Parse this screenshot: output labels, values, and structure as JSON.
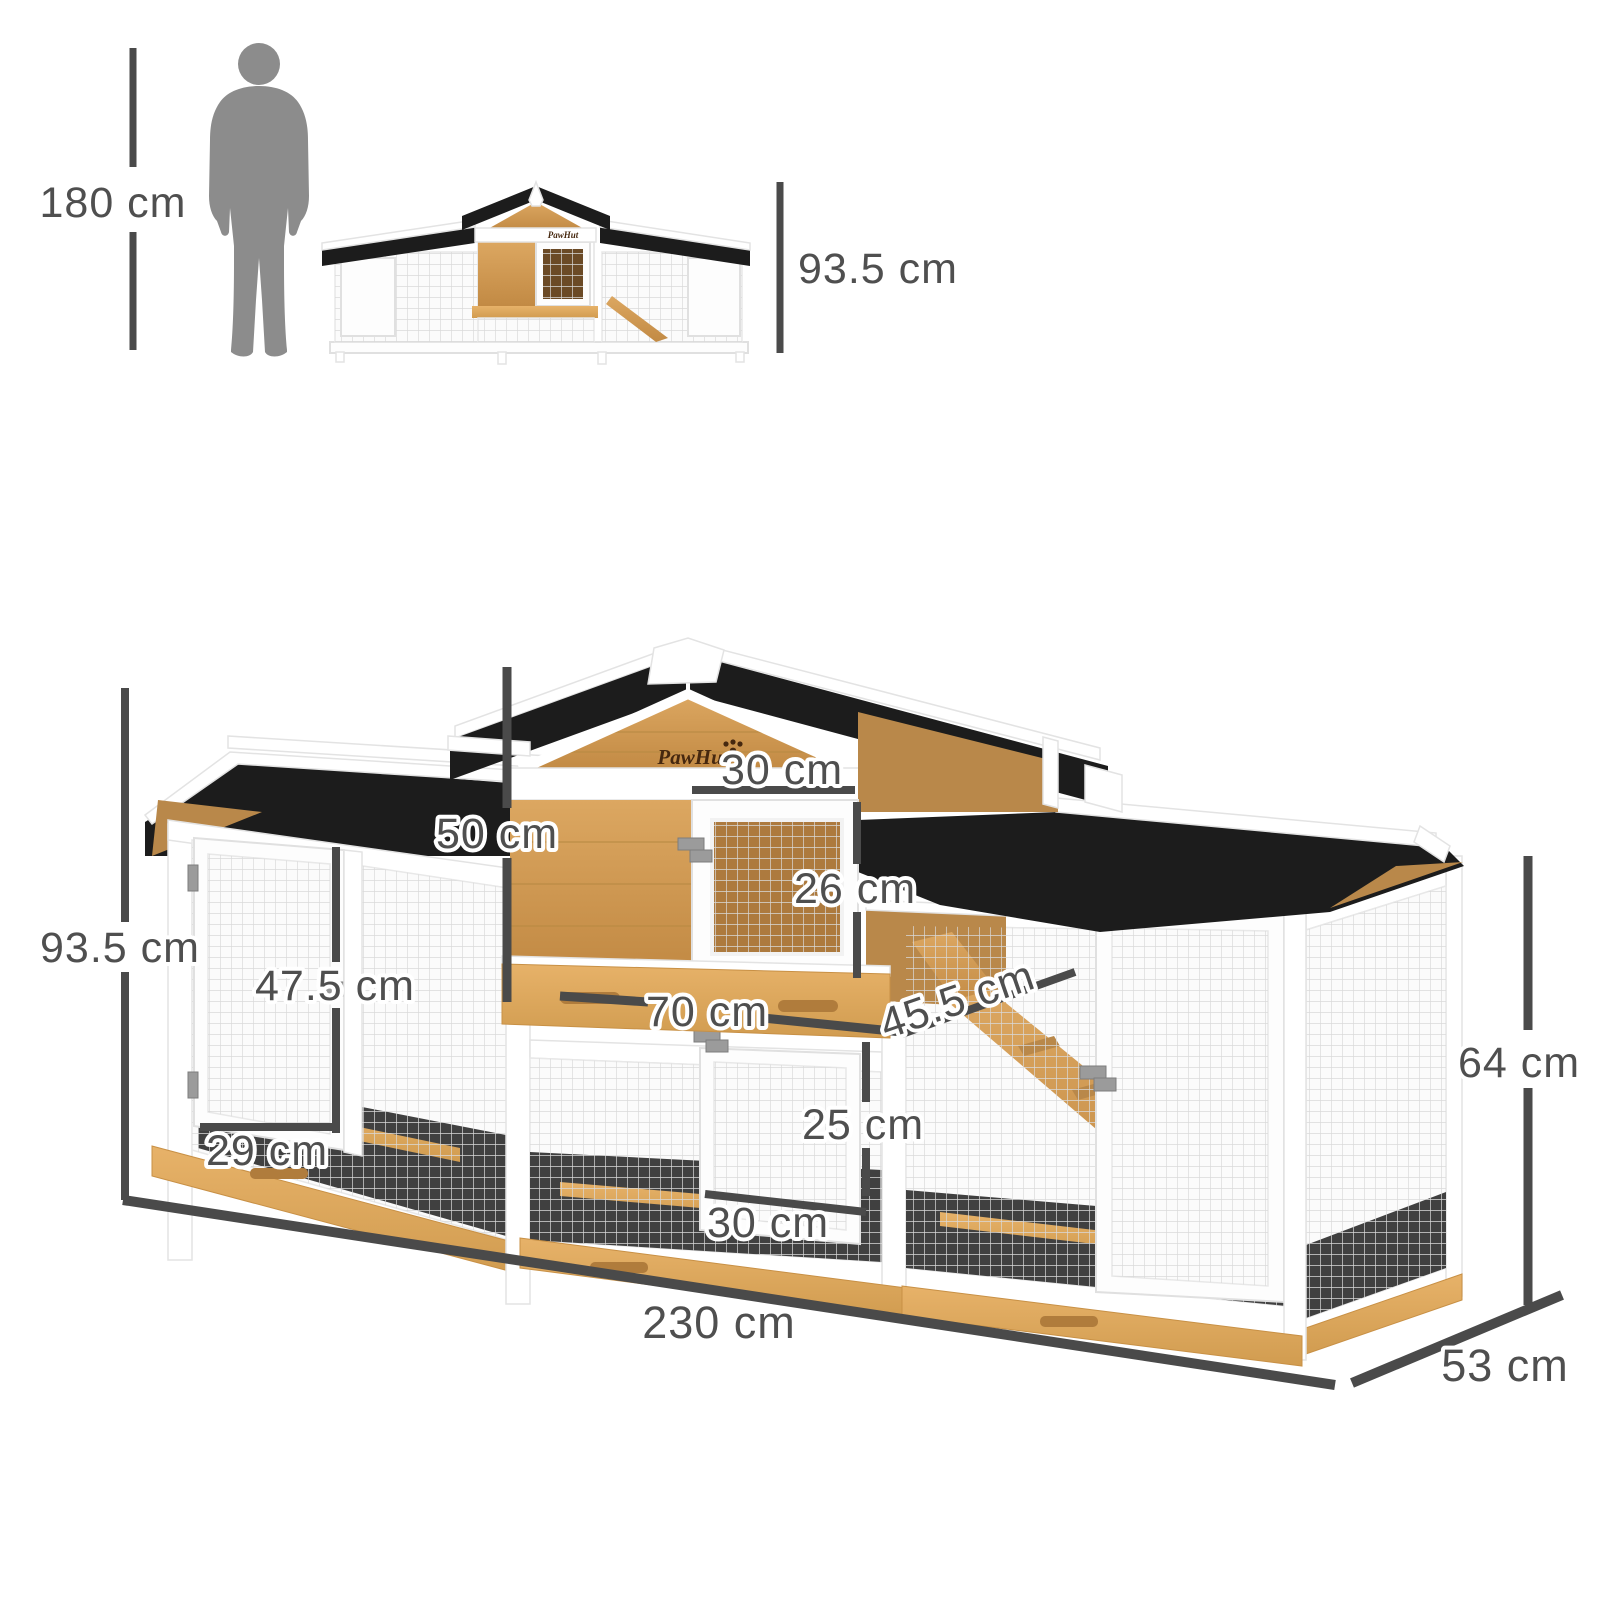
{
  "brand": {
    "logo_text": "PawHut"
  },
  "scale_reference": {
    "person_height_label": "180 cm",
    "hutch_height_label": "93.5 cm"
  },
  "main_dimensions": {
    "overall_height": "93.5 cm",
    "upper_hutch_height": "50 cm",
    "upper_door_width": "30 cm",
    "upper_door_height": "26 cm",
    "left_door_height": "47.5 cm",
    "left_door_width": "29 cm",
    "upper_hutch_width": "70 cm",
    "ramp_length": "45.5 cm",
    "lower_door_height": "25 cm",
    "lower_door_width": "30 cm",
    "overall_width": "230 cm",
    "overall_depth": "53 cm",
    "run_height": "64 cm"
  },
  "colors": {
    "accent_yellow": "#F2A51E",
    "dimension_line": "#4A4A4A",
    "label_text": "#4F4F4F",
    "roof_black": "#1C1C1C",
    "wood_light": "#DCA761",
    "wood_dark": "#B9884A",
    "frame_white": "#FFFFFF",
    "silhouette_gray": "#8C8C8C",
    "mesh_line": "#D9D9D9"
  }
}
